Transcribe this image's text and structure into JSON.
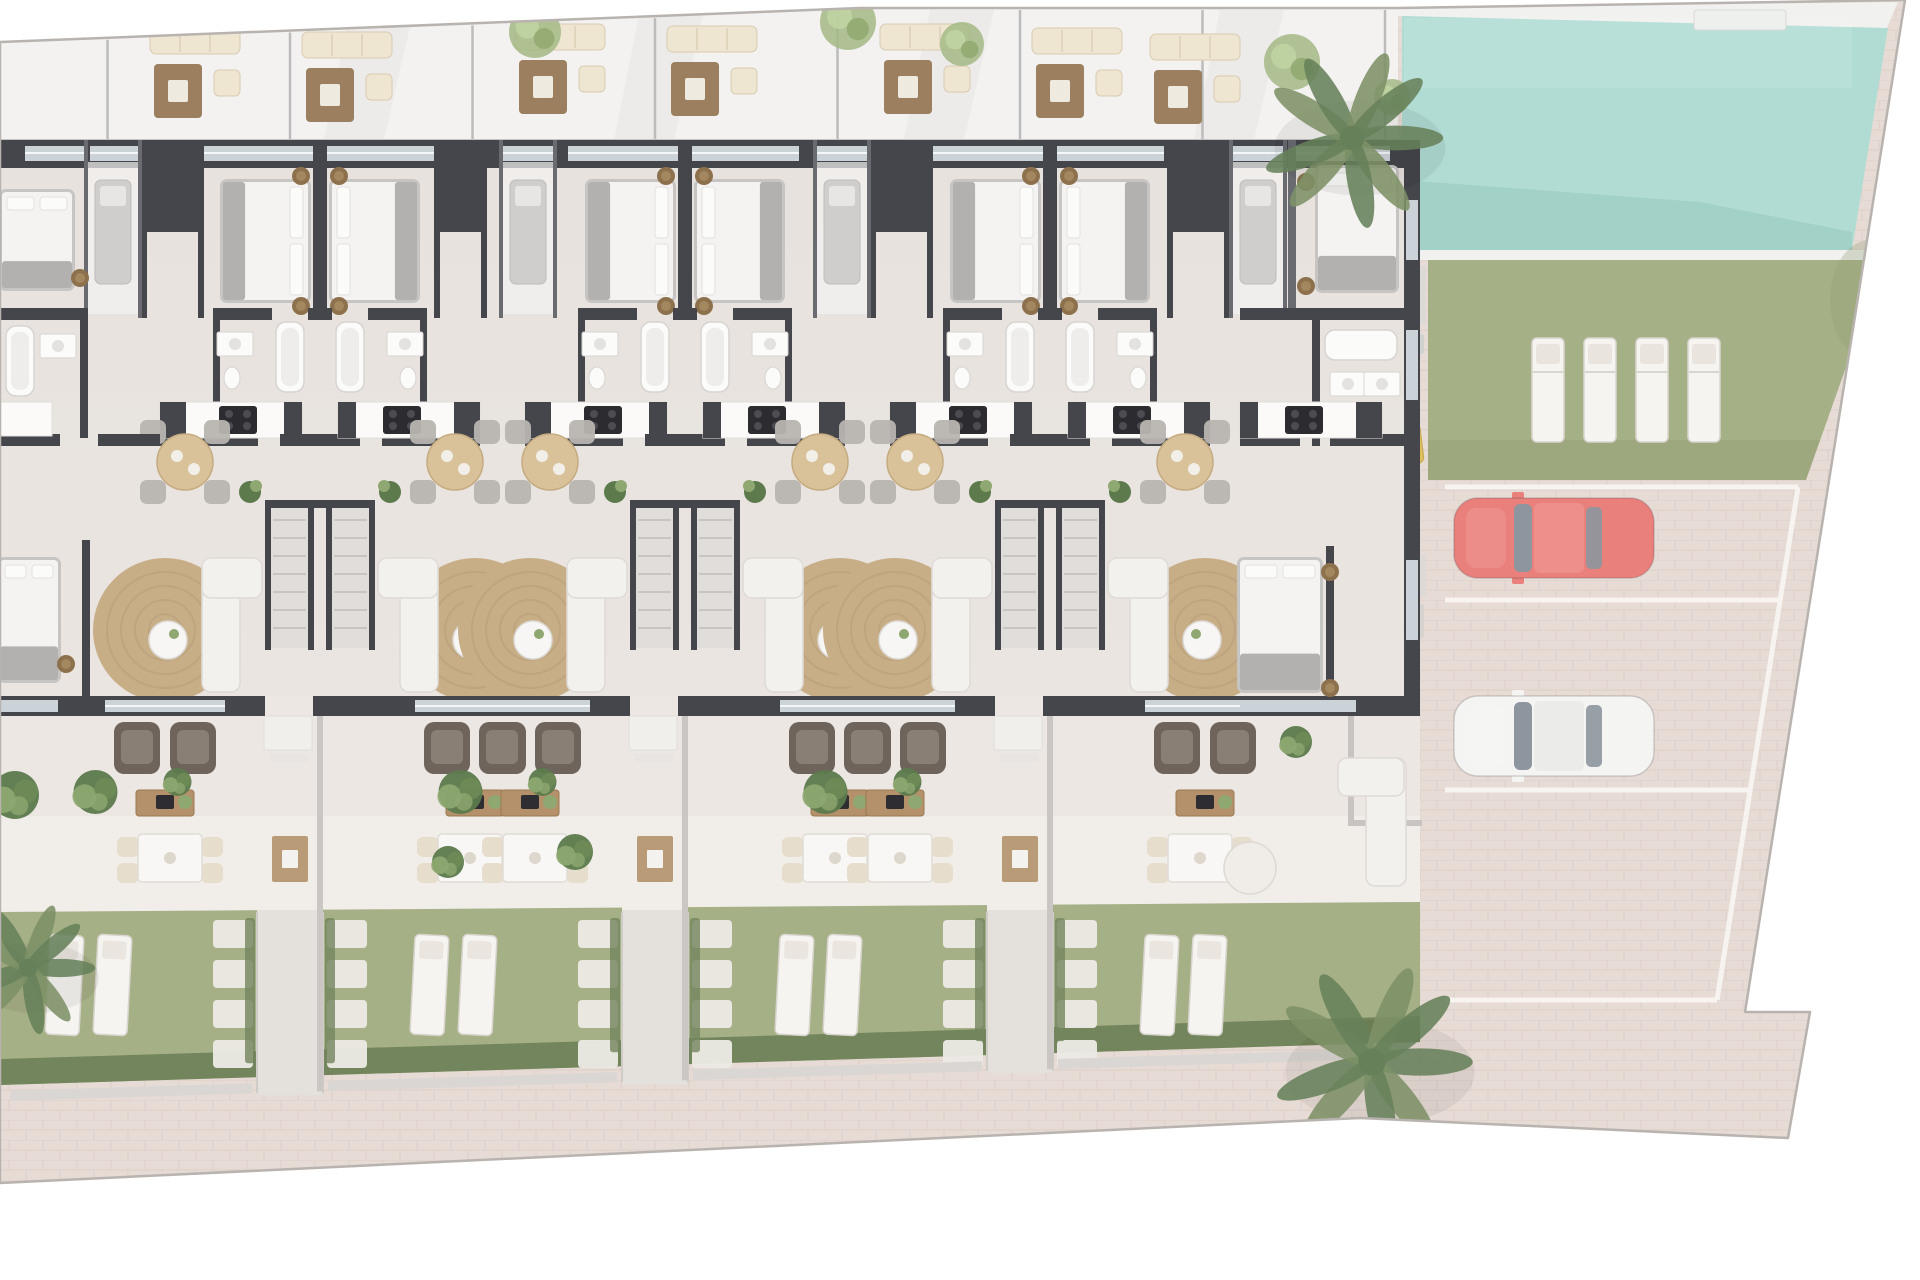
{
  "title": "Ground-floor site plan — terraced residential units with communal pool and parking",
  "plan": {
    "type": "architectural-site-plan",
    "view": "top-down rendered floor plan",
    "building": {
      "visible_unit_columns": 8,
      "mirrored_pairs": 3,
      "pair_centers": [
        320,
        685,
        1050
      ],
      "partial_unit_cut_at_left_edge": true,
      "end_unit_at_right": true,
      "unit_features": [
        "double bedroom with pouf nightstands",
        "side balcony with daybed",
        "bathroom with tub and sink",
        "kitchenette with cooktop",
        "round dining table with four chairs",
        "living area with round jute rug and white corner sofa",
        "internal staircase",
        "rear terrace with two armchairs and media sideboard",
        "patio dining set",
        "private lawn with two sun loungers and stepping stones",
        "hedge with gate to rear walkway"
      ]
    },
    "amenities": {
      "swimming_pool": {
        "present": true,
        "loungers_on_pool_lawn": 4,
        "skimmer_step": 1
      },
      "parking": {
        "marked_spaces": 3,
        "vehicles": [
          {
            "type": "car",
            "color_name": "red",
            "space": 1
          },
          {
            "type": "car",
            "color_name": "white",
            "space": 2
          }
        ],
        "scooter": {
          "present": true,
          "color_name": "yellow"
        }
      },
      "landscaping": {
        "palm_trees": 2,
        "round_trees": 5,
        "bushes": true,
        "paved_promenade": true
      }
    },
    "counts": {
      "garden_lounger_pairs": 4,
      "garden_paths": 3,
      "stepping_stone_columns": 6,
      "roof_lounge_sets": 7
    },
    "colors": {
      "outside": "#ffffff",
      "paving": "#e7dbd5",
      "paving_line": "#d8c8c1",
      "boundary": "#b8b3af",
      "roof_floor": "#f3f2f1",
      "roof_shade": "#e7e5e4",
      "roof_sep": "#bdbcbc",
      "interior": "#eae5e1",
      "interior_shade": "#dcd7d4",
      "terrace_floor": "#ece7e3",
      "patio_floor": "#f1eeea",
      "path": "#e4e1dd",
      "wall": "#45464c",
      "wall_mid": "#6a6b70",
      "glass": "#ccd3d8",
      "lawn": "#a6b086",
      "lawn_shade": "#8e9b74",
      "hedge": "#73855c",
      "pool": "#b0dcd3",
      "pool_deep": "#94c6bc",
      "deck": "#f1f1ef",
      "lounger": "#f6f4f1",
      "lounger_edge": "#d9d4cd",
      "stone": "#eceae5",
      "bed_frame": "#c7c5c4",
      "bed_white": "#f4f3f2",
      "bed_gray": "#b3b1b0",
      "pillow": "#fbfbfa",
      "pouf": "#8d714c",
      "sofa": "#f3f1ee",
      "sofa_line": "#dedad6",
      "rug": "#c8ae87",
      "rug_ring": "#b89f79",
      "wood": "#b4916a",
      "wood_dark": "#97causb",
      "chair_gray": "#b8b4b0",
      "armchair": "#6e645c",
      "armchair_dark": "#8a7f74",
      "cooktop": "#2b2b30",
      "plant": "#5c7a4c",
      "plant_light": "#8fa871",
      "palm": "#7d9166",
      "palm_dark": "#66815a",
      "tree": "#a3ba85",
      "car_red": "#ea807c",
      "car_white": "#f4f4f3",
      "car_glass": "#8d969e",
      "scooter_yellow": "#ddbf5e",
      "white_line": "#f6f3f0"
    }
  }
}
